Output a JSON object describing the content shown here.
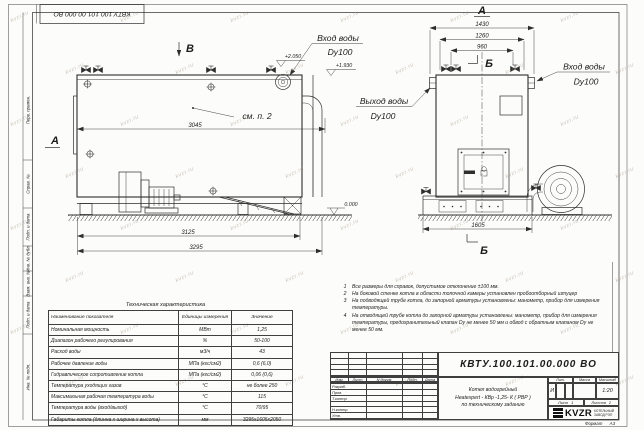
{
  "stamp_top": "КВТУ.100.101.00.000 ВО",
  "watermark": "kvzr.ru",
  "margin_labels": [
    "Перв. примен.",
    "Справ. №",
    "Подп. и дата",
    "Инв. № дубл.",
    "Взам. инв. №",
    "Подп. и дата",
    "Инв. № подл."
  ],
  "drawing": {
    "view_b": "В",
    "view_a_side": "А",
    "view_a_front": "А",
    "section_b_top": "Б",
    "section_b_bottom": "Б",
    "see_note": "см. п. 2",
    "elev_plus_2050": "+2.050",
    "elev_plus_1930": "+1.930",
    "elev_zero": "0.000",
    "inlet_top_line1": "Вход воды",
    "inlet_top_line2": "Dy100",
    "inlet_right_line1": "Вход воды",
    "inlet_right_line2": "Dy100",
    "outlet_line1": "Выход воды",
    "outlet_line2": "Dy100",
    "dim_3045": "3045",
    "dim_3125": "3125",
    "dim_3295": "3295",
    "dim_1430": "1430",
    "dim_1260": "1260",
    "dim_960": "960",
    "dim_1605": "1605"
  },
  "notes": {
    "items": [
      {
        "num": "1",
        "text": "Все размеры для справок, допустимое отклонение ±100 мм."
      },
      {
        "num": "2",
        "text": "На боковой стенке котла в области топочной камеры установлен пробоотборный штуцер"
      },
      {
        "num": "3",
        "text": "На  подводящей трубе котла, до запорной арматуры установлены: манометр, прибор для измерения температуры."
      },
      {
        "num": "4",
        "text": "На отводящей трубе котла до запорной арматуры установлены: манометр, прибор для измерения температуры, предохранительный клапан Dу не менее 50 мм и обвод с обратным клапаном Dу не менее 50 мм."
      }
    ]
  },
  "tech_table": {
    "title": "Техническая характеристика",
    "headers": [
      "Наименование показателя",
      "Единицы измерения",
      "Значение"
    ],
    "rows": [
      [
        "Номинальная мощность",
        "МВт",
        "1,25"
      ],
      [
        "Диапазон рабочего регулирования",
        "%",
        "50-100"
      ],
      [
        "Расход воды",
        "м3/ч",
        "43"
      ],
      [
        "Рабочее давление воды",
        "МПа (кгс/см2)",
        "0,6 (6,0)"
      ],
      [
        "Гидравлическое сопротивление котла",
        "МПа (кгс/см2)",
        "0,06 (0,6)"
      ],
      [
        "Температура уходящих газов",
        "°С",
        "не более 250"
      ],
      [
        "Максимальная рабочая температура воды",
        "°С",
        "115"
      ],
      [
        "Температура воды (вход/выход)",
        "°С",
        "70/95"
      ],
      [
        "Габариты котла (длинна х ширина х высота)",
        "мм",
        "3295х1605х2050"
      ]
    ]
  },
  "title_block": {
    "doc_number": "КВТУ.100.101.00.000  ВО",
    "columns": [
      "Изм.",
      "Лист",
      "N докум.",
      "Подп.",
      "Дата"
    ],
    "rows": [
      "Разраб.",
      "Пров.",
      "Т.контр.",
      "",
      "Н.контр.",
      "Утв."
    ],
    "title_line1": "Котел водогрейный",
    "title_line2": "Heatexpert - КВр -1,25- К ( РВР )",
    "title_line3": "по техническому заданию",
    "lit_label": "Лит.",
    "lit_value": "И",
    "mass_label": "Масса",
    "scale_label": "Масштаб",
    "scale_value": "1:20",
    "sheet_label": "Лист",
    "sheet_value": "1",
    "sheets_label": "Листов",
    "sheets_value": "2",
    "logo": "KVZR",
    "company_line1": "КОТЕЛЬНЫЙ",
    "company_line2": "ЗАВОД РЭП",
    "format_label": "Формат",
    "format_value": "А3"
  }
}
